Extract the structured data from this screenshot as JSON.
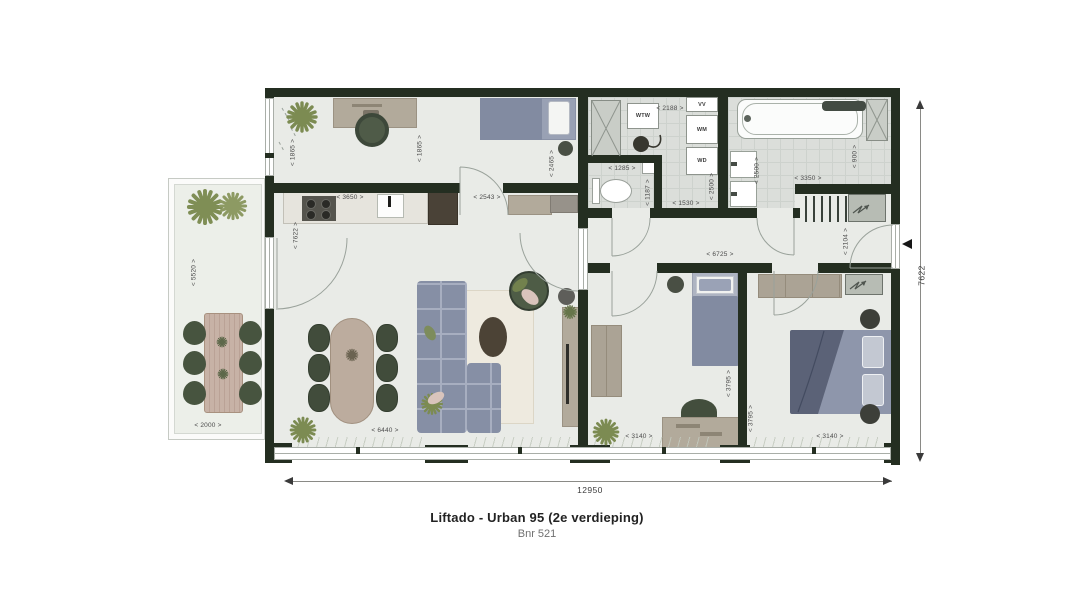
{
  "title": {
    "name": "Liftado - Urban 95 (2e verdieping)",
    "number": "Bnr 521"
  },
  "totals": {
    "width": "12950",
    "depth": "7622"
  },
  "labels": {
    "wtw": "WTW",
    "vv": "VV",
    "wm": "WM",
    "wd": "WD"
  },
  "dims": {
    "balcony_length": "< 5520 >",
    "balcony_width": "< 2000 >",
    "study_window": "< 1865 >",
    "study_depth": "< 1865 >",
    "bed_nook_depth": "< 2465 >",
    "bed_nook_width": "< 2543 >",
    "kitchen_width": "< 3650 >",
    "living_depth": "< 7622 >",
    "living_width": "< 6440 >",
    "tech_width": "< 2188 >",
    "tech_depth": "< 2500 >",
    "tech_inner_width": "< 1530 >",
    "toilet_width": "< 1285 >",
    "toilet_depth": "< 1187 >",
    "bathroom_depth": "< 2500 >",
    "bathroom_width": "< 3350 >",
    "bathroom_side": "< 900 >",
    "hall_width": "< 6725 >",
    "entry_depth": "< 2104 >",
    "bedroom1_width": "< 3140 >",
    "bedroom1_depth": "< 3795 >",
    "bedroom2_width": "< 3140 >",
    "bedroom2_depth": "< 3795 >"
  },
  "colors": {
    "wall": "#242e21",
    "floor": "#e9ebe7",
    "tile": "#dbdeda",
    "furniture_taupe": "#b2aa9b",
    "bed_blue": "#828ba1",
    "sofa_blue": "#868fa5",
    "chair_green": "#414c3b",
    "plant_green": "#7c8b52",
    "wood": "#c7b2a6"
  }
}
